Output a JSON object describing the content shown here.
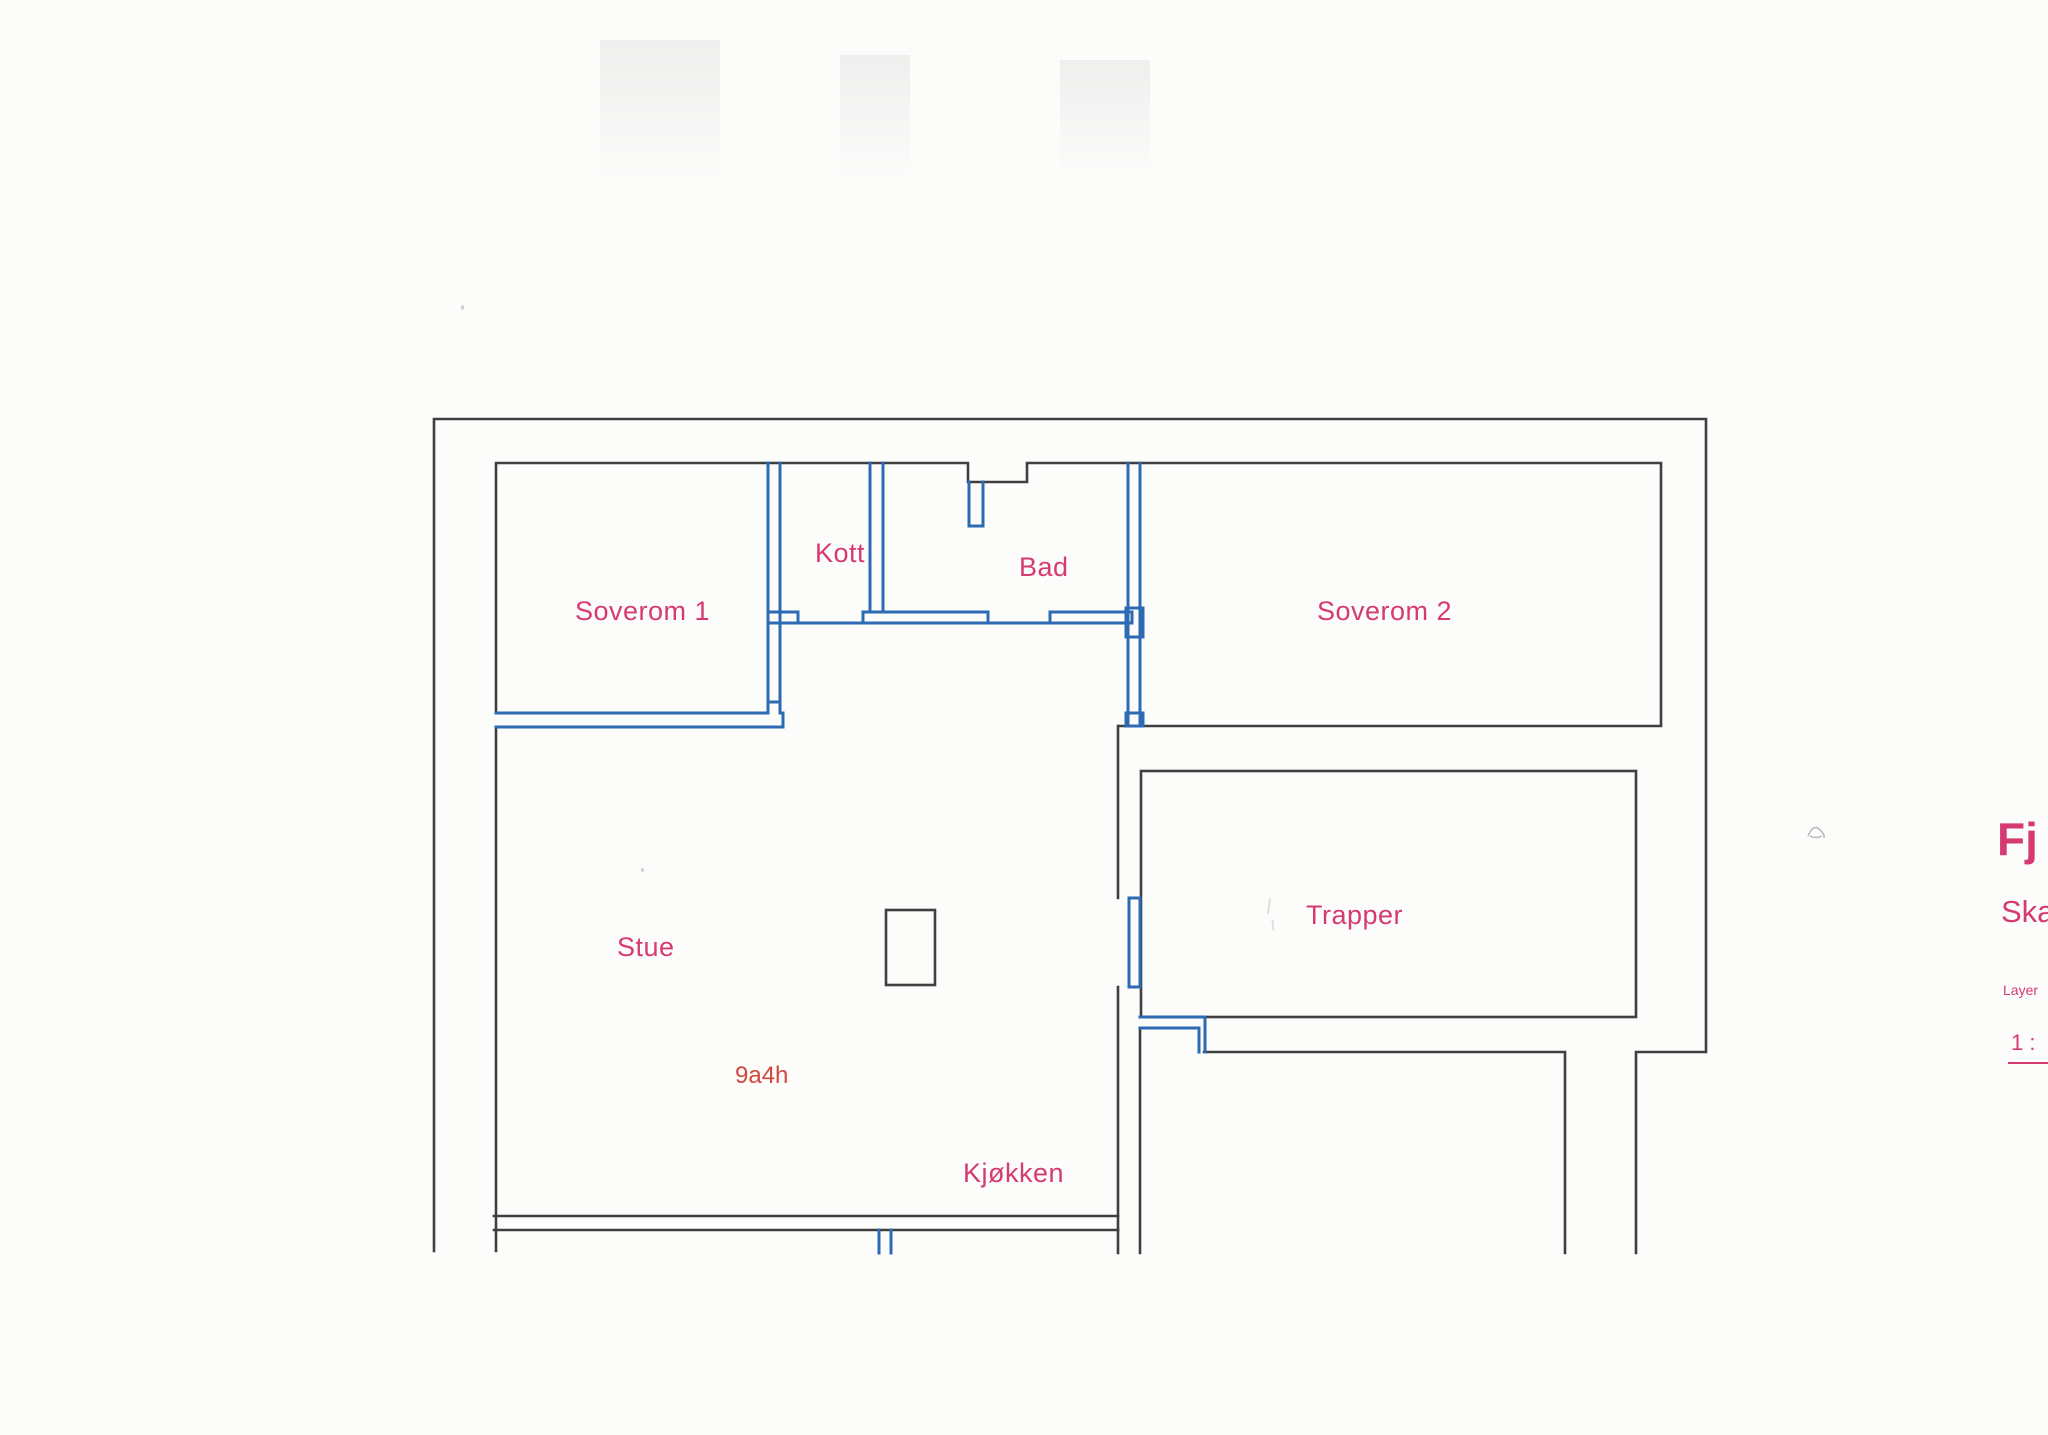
{
  "document": {
    "kind": "scanned floor plan drawing"
  },
  "colors": {
    "paper": "#fcfcfb",
    "wall_dark": "#3f3f3f",
    "wall_blue": "#2d6ab4",
    "label_pink": "#d63a72",
    "area_red": "#d2473d"
  },
  "floor_plan": {
    "rooms": [
      {
        "label": "Soverom 1"
      },
      {
        "label": "Kott"
      },
      {
        "label": "Bad"
      },
      {
        "label": "Soverom 2"
      },
      {
        "label": "Stue"
      },
      {
        "label": "Trapper"
      },
      {
        "label": "Kjøkken"
      }
    ],
    "area_code": "9a4h"
  },
  "side_text": {
    "title_fragment": "Fj",
    "scale_heading_fragment": "Ska",
    "layer_label_fragment": "Layer",
    "scale_ratio_fragment": "1 :"
  }
}
